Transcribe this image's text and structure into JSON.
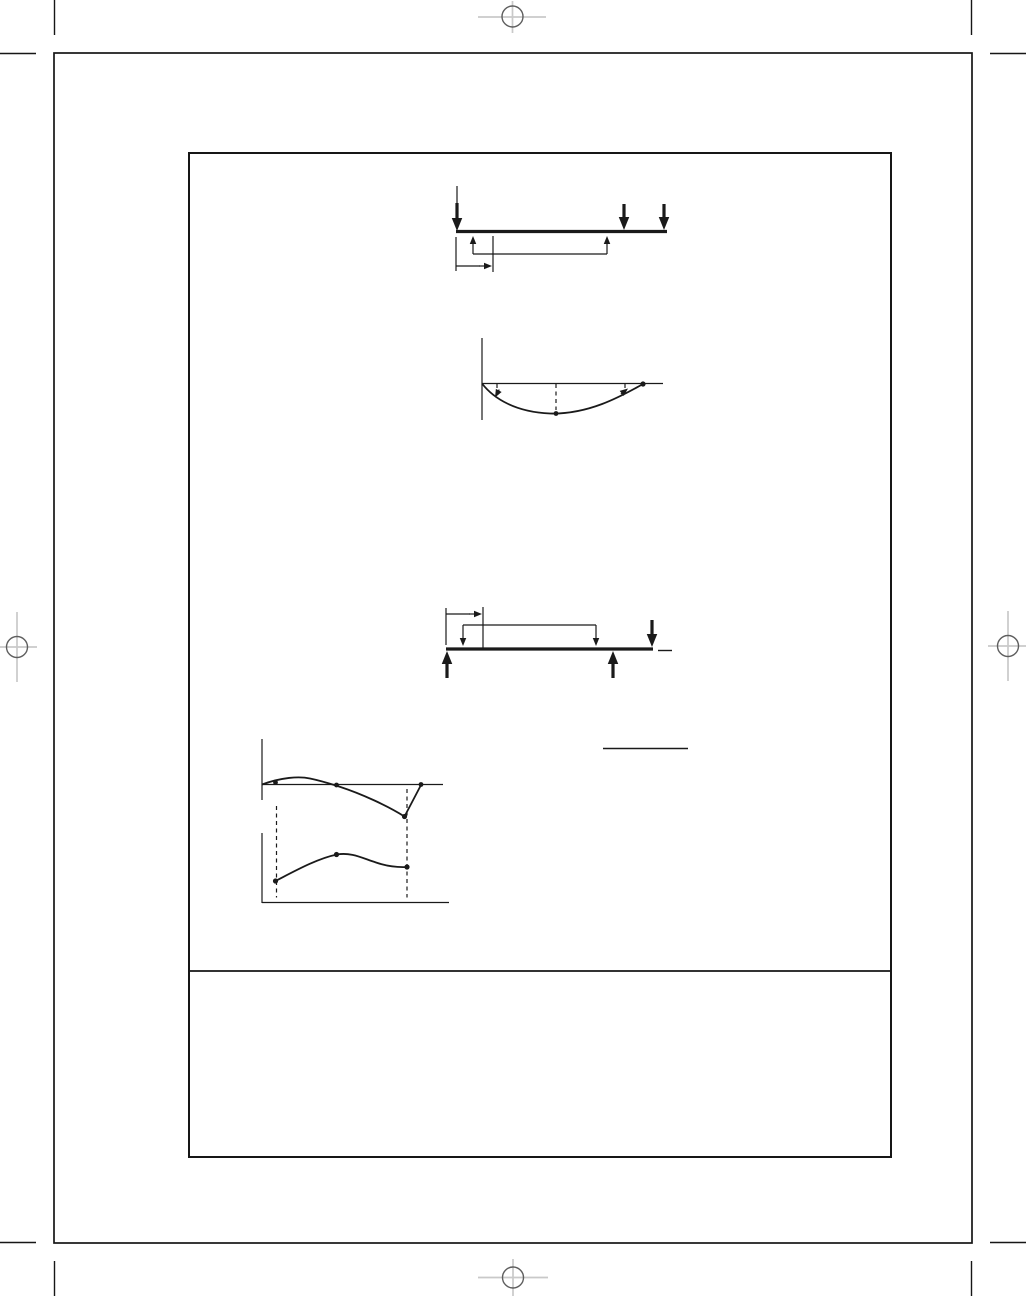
{
  "page": {
    "background": "#ffffff",
    "ink": "#1a1a1a",
    "registration_cross_color": "#c9c9c9",
    "registration_circle_color": "#5e5e5e"
  },
  "figures": [
    {
      "id": "figure-beam-point-loads",
      "role": "beam-diagram-three-point-loads-with-reactions-and-dimension",
      "lines": [
        [
          456,
          231.5,
          667,
          231.5,
          3.2
        ],
        [
          457,
          186,
          457,
          204,
          1.2
        ],
        [
          473,
          254,
          607,
          254,
          1.2
        ],
        [
          456,
          237,
          456,
          271,
          1.2
        ],
        [
          493,
          236,
          493,
          272,
          1.2
        ],
        [
          456,
          266,
          480,
          266,
          1.2
        ]
      ],
      "arrows": [
        [
          457,
          231,
          90,
          28,
          "T"
        ],
        [
          624,
          230,
          90,
          26,
          "T"
        ],
        [
          664,
          230,
          90,
          26,
          "T"
        ],
        [
          473,
          236,
          270,
          18,
          "s"
        ],
        [
          607,
          236,
          270,
          18,
          "s"
        ],
        [
          492,
          266,
          0,
          13,
          "s"
        ]
      ]
    },
    {
      "id": "figure-moment-curve",
      "role": "sagging-moment-curve-with-axis-and-dashed-ordinates",
      "lines": [
        [
          482,
          338,
          482,
          420,
          1.2
        ],
        [
          482,
          383.5,
          663,
          383.5,
          1.2
        ]
      ],
      "dashed": [
        [
          497,
          384,
          497,
          393
        ],
        [
          556,
          384,
          556,
          410
        ],
        [
          625,
          384,
          625,
          388
        ]
      ],
      "curves": [
        "M482 383.5 C494 399 516 412 550 413.5 C588 414.5 620 397 643 384"
      ],
      "dots": [
        [
          643,
          384,
          2.6
        ],
        [
          556,
          413.5,
          2.4
        ]
      ],
      "arrows": [
        [
          495,
          397.5,
          118,
          9,
          "s"
        ],
        [
          628,
          388.5,
          322,
          9,
          "s"
        ]
      ]
    },
    {
      "id": "figure-beam-overhang",
      "role": "overhanging-beam-with-reactions-end-load-and-dimension",
      "lines": [
        [
          446,
          649,
          653,
          649,
          3.2
        ],
        [
          658,
          650.5,
          672,
          650.5,
          1.4
        ],
        [
          463,
          625,
          596,
          625,
          1.2
        ],
        [
          446,
          608,
          446,
          645,
          1.2
        ],
        [
          483,
          607,
          483,
          648,
          1.2
        ],
        [
          446,
          614,
          470,
          614,
          1.2
        ]
      ],
      "arrows": [
        [
          463,
          646,
          90,
          21,
          "s"
        ],
        [
          596,
          646,
          90,
          21,
          "s"
        ],
        [
          482,
          614,
          0,
          13,
          "s"
        ],
        [
          447,
          651,
          270,
          27,
          "T"
        ],
        [
          613,
          651,
          270,
          27,
          "T"
        ],
        [
          652,
          647,
          90,
          27,
          "T"
        ]
      ]
    },
    {
      "id": "figure-fraction-bar",
      "role": "horizontal-rule-fraction-bar",
      "lines": [
        [
          603,
          748.5,
          688,
          748.5,
          1.6
        ]
      ]
    },
    {
      "id": "figure-overhang-moment-curve",
      "role": "moment-curve-for-overhanging-beam-with-dashed-links",
      "lines": [
        [
          262,
          739,
          262,
          800,
          1.2
        ],
        [
          262,
          784.5,
          443,
          784.5,
          1.2
        ]
      ],
      "dashed": [
        [
          276.5,
          806,
          276.5,
          897.5
        ],
        [
          407,
          789,
          407,
          897.5
        ]
      ],
      "curves": [
        "M262 784.5 C281 777.5 299 776 310 778.5 C322 781 331 784 339 786.5 C362 794 388 806 404.5 816.5 L421 785"
      ],
      "dots": [
        [
          275.5,
          782.5,
          2.4
        ],
        [
          336.5,
          785,
          2.4
        ],
        [
          404.5,
          816.5,
          2.6
        ],
        [
          421,
          784.5,
          2.4
        ]
      ]
    },
    {
      "id": "figure-overhang-deflection-curve",
      "role": "deflection-curve-for-overhanging-beam",
      "lines": [
        [
          262,
          833,
          262,
          903,
          1.2
        ],
        [
          262,
          902.5,
          449,
          902.5,
          1.2
        ]
      ],
      "curves": [
        "M275.5 881 C293 872 317 858.5 337 854.5 C351 852 362 858 376 862.5 C386 866 396 867.5 407 867"
      ],
      "dots": [
        [
          275.5,
          881,
          2.6
        ],
        [
          336.5,
          854.5,
          2.6
        ],
        [
          407,
          867,
          2.6
        ]
      ]
    }
  ]
}
